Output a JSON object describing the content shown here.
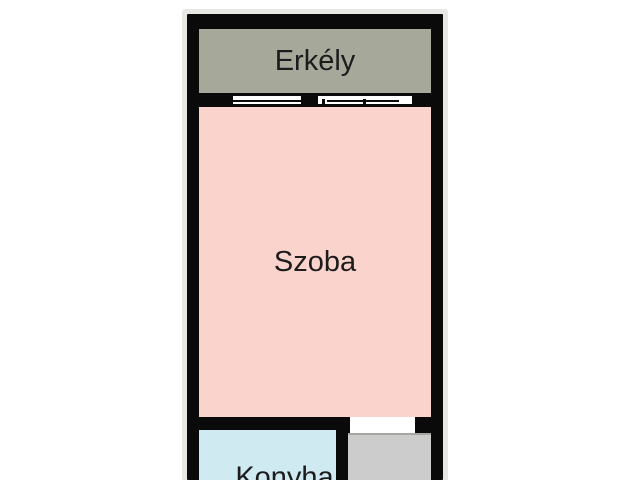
{
  "floorplan": {
    "background_color": "#ffffff",
    "wall_color": "#0a0a0a",
    "outer_glow_color": "#e7e7e3",
    "opening_color": "#ffffff",
    "rooms": {
      "balcony": {
        "label": "Erkély",
        "color": "#a6a99a"
      },
      "living_room": {
        "label": "Szoba",
        "color": "#fbd3cd"
      },
      "kitchen": {
        "label": "Konyha",
        "color": "#cfeaf1"
      },
      "hallway": {
        "color": "#cccccc"
      }
    }
  }
}
